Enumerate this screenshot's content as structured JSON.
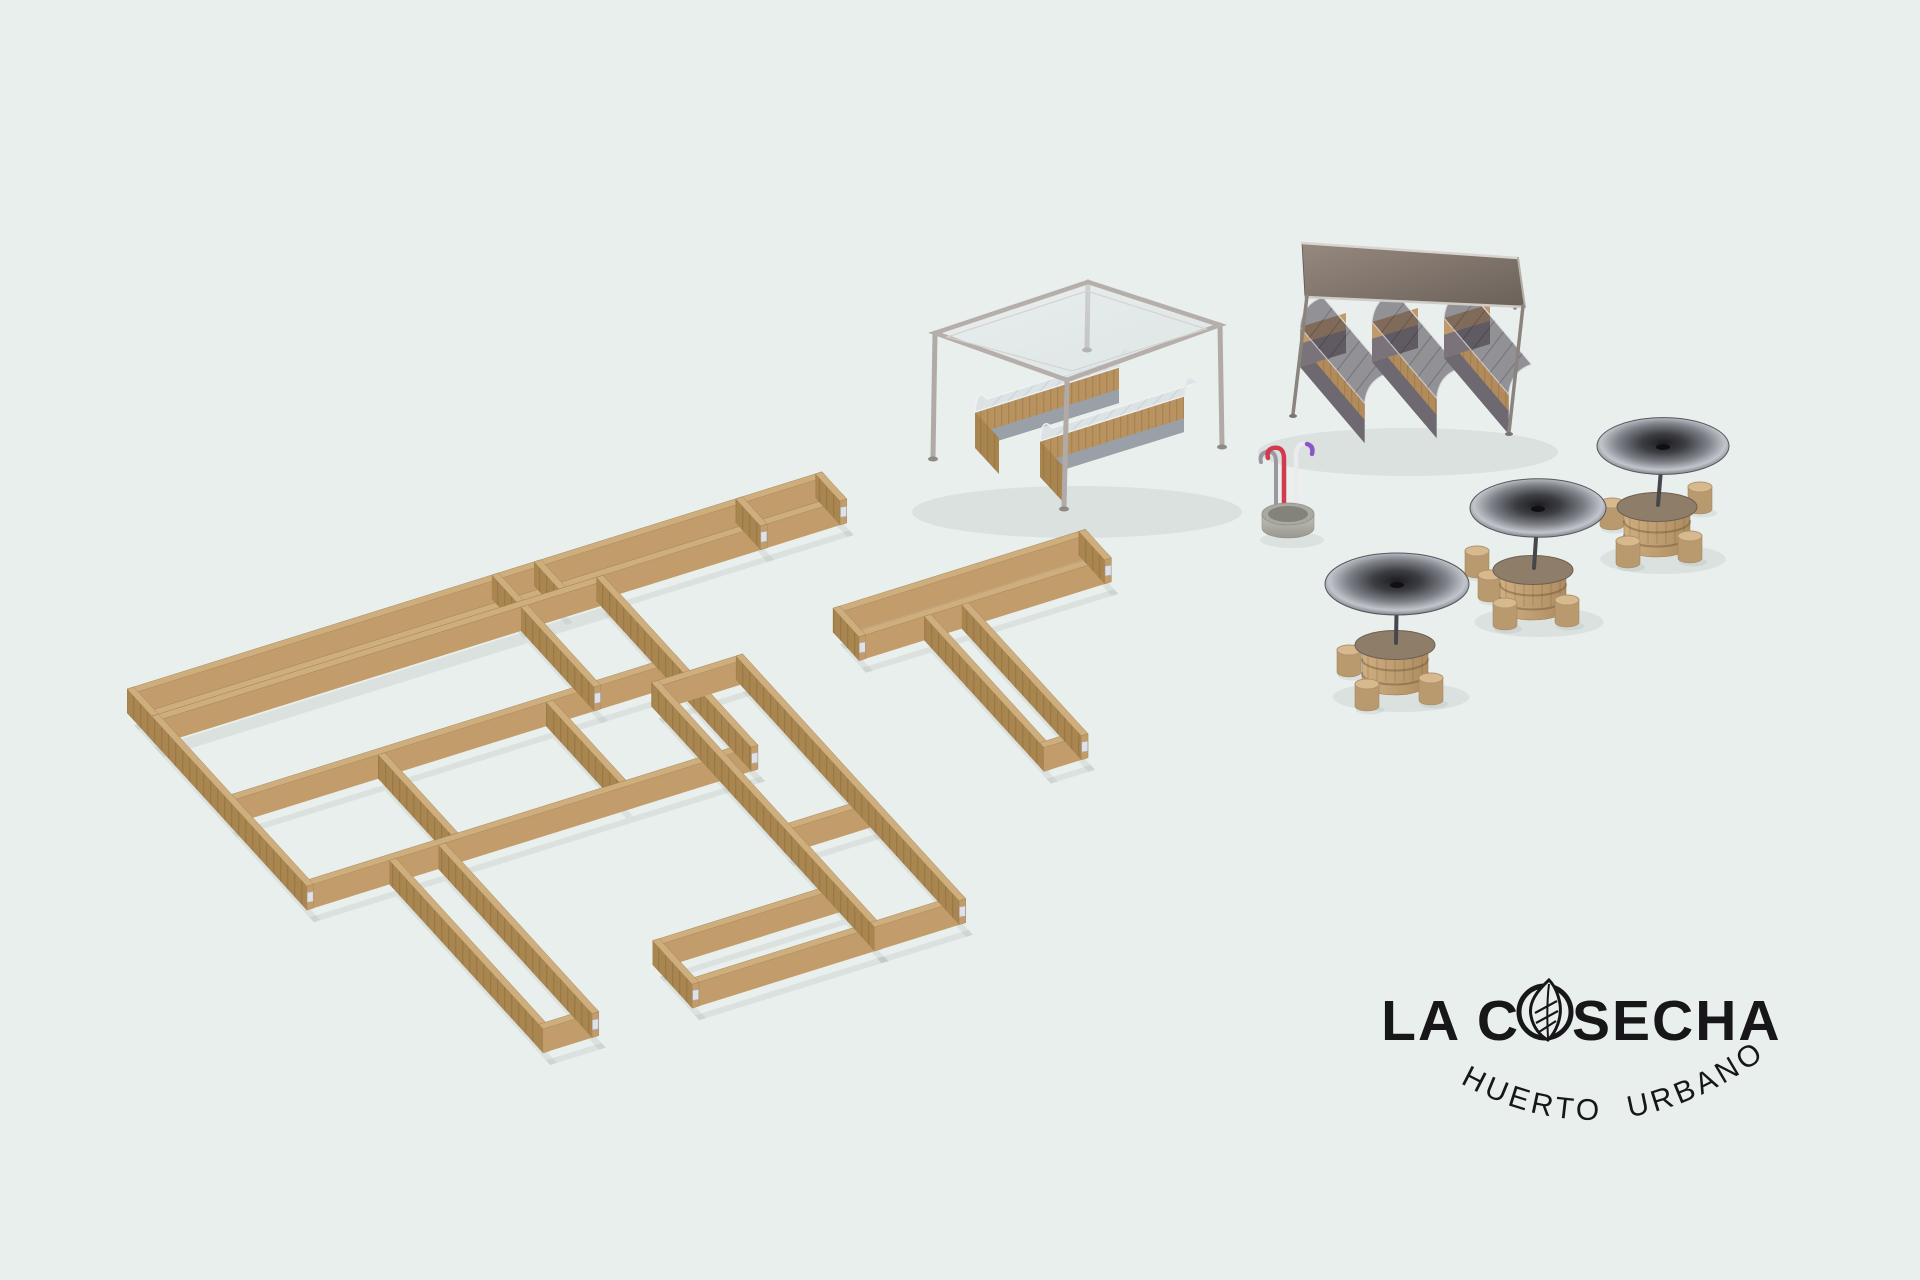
{
  "canvas": {
    "width": 1920,
    "height": 1280,
    "background": "#e9efec"
  },
  "brand": {
    "name": "LA COSECHA",
    "name_pre": "LA C",
    "name_post": "SECHA",
    "subtitle": "HUERTO URBANO",
    "color": "#17171a",
    "leaf_icon": "leaf-in-circle"
  },
  "scene": {
    "iso": {
      "u": [
        0.96,
        -0.3
      ],
      "v": [
        0.62,
        0.68
      ],
      "origin": [
        127,
        713
      ],
      "wall_height": 24,
      "wall_thickness": 7
    },
    "wood": {
      "top": "#cfae7e",
      "face_u": "#c29c6a",
      "face_v": "#a9854f",
      "bracket": "#e0e1e6",
      "bracket_edge": "#a9aab2"
    },
    "shadow_color": "rgba(98,112,104,0.10)",
    "frames": [
      {
        "id": "top-chain",
        "walls": [
          [
            "u",
            0,
            0,
            724
          ],
          [
            "u",
            0,
            33,
            724
          ],
          [
            "v",
            0,
            0,
            40
          ],
          [
            "v",
            717,
            0,
            40
          ],
          [
            "v",
            380,
            0,
            40
          ],
          [
            "v",
            424,
            0,
            40
          ],
          [
            "v",
            634,
            0,
            40
          ]
        ]
      },
      {
        "id": "big-grid",
        "walls": [
          [
            "u",
            0,
            40,
            470
          ],
          [
            "u",
            0,
            158,
            470
          ],
          [
            "u",
            0,
            283,
            470
          ],
          [
            "v",
            0,
            40,
            250
          ],
          [
            "v",
            463,
            40,
            250
          ],
          [
            "v",
            380,
            47,
            118
          ],
          [
            "v",
            155,
            165,
            118
          ],
          [
            "v",
            330,
            165,
            118
          ]
        ]
      },
      {
        "id": "south-wing",
        "walls": [
          [
            "v",
            86,
            290,
            248
          ],
          [
            "v",
            137,
            290,
            248
          ],
          [
            "u",
            86,
            531,
            58
          ]
        ]
      },
      {
        "id": "seven-compound",
        "walls": [
          [
            "u",
            632,
            160,
            263
          ],
          [
            "u",
            632,
            195,
            263
          ],
          [
            "v",
            632,
            160,
            42
          ],
          [
            "v",
            888,
            160,
            42
          ],
          [
            "v",
            700,
            202,
            193
          ],
          [
            "v",
            739,
            202,
            193
          ],
          [
            "u",
            700,
            388,
            46
          ]
        ]
      },
      {
        "id": "tall-compound",
        "walls": [
          [
            "u",
            430,
            180,
            95
          ],
          [
            "v",
            430,
            180,
            360
          ],
          [
            "v",
            518,
            180,
            360
          ],
          [
            "u",
            430,
            390,
            95
          ],
          [
            "u",
            430,
            533,
            95
          ],
          [
            "u",
            240,
            476,
            190
          ],
          [
            "u",
            240,
            533,
            197
          ],
          [
            "v",
            240,
            476,
            64
          ]
        ]
      }
    ],
    "pergola": {
      "frame_color": "#b3acа8",
      "roof": [
        [
          935,
          333
        ],
        [
          1088,
          282
        ],
        [
          1220,
          325
        ],
        [
          1067,
          380
        ]
      ],
      "roof_inset": [
        [
          947,
          337
        ],
        [
          1087,
          291
        ],
        [
          1206,
          329
        ],
        [
          1072,
          371
        ]
      ],
      "legs_back": [
        [
          [
            935,
            333
          ],
          [
            933,
            457
          ]
        ],
        [
          [
            1220,
            325
          ],
          [
            1222,
            445
          ]
        ],
        [
          [
            1088,
            282
          ],
          [
            1087,
            348
          ]
        ]
      ],
      "leg_front": [
        [
          1067,
          380
        ],
        [
          1064,
          507
        ]
      ],
      "planters": [
        {
          "w": [
            975,
            412
          ],
          "len": 150
        },
        {
          "w": [
            1040,
            441
          ],
          "len": 150
        }
      ]
    },
    "canopy": {
      "roof": [
        [
          1302,
          243
        ],
        [
          1518,
          258
        ],
        [
          1525,
          307
        ],
        [
          1305,
          297
        ]
      ],
      "legs": [
        [
          [
            1307,
            296
          ],
          [
            1293,
            414
          ]
        ],
        [
          [
            1523,
            306
          ],
          [
            1509,
            432
          ]
        ],
        [
          [
            1517,
            259
          ],
          [
            1515,
            308
          ]
        ]
      ],
      "planters": [
        {
          "n": [
            1300,
            327
          ],
          "len": 106
        },
        {
          "n": [
            1372,
            322
          ],
          "len": 106
        },
        {
          "n": [
            1444,
            318
          ],
          "len": 106
        }
      ]
    },
    "fountain": {
      "pos": [
        1288,
        514
      ],
      "tube_red": "#d23a50",
      "tube_grey": "#9a97a0",
      "tube_white": "#eceaef",
      "tube_purple": "#8a55c8"
    },
    "tables": [
      {
        "top": [
          1657,
          507
        ],
        "umbrella": [
          1663,
          446
        ],
        "ur": 66,
        "stools": [
          [
            -45,
            -4
          ],
          [
            -29,
            34
          ],
          [
            33,
            29
          ],
          [
            43,
            -20
          ]
        ]
      },
      {
        "top": [
          1533,
          570
        ],
        "umbrella": [
          1538,
          508
        ],
        "ur": 68,
        "stools": [
          [
            -56,
            -19
          ],
          [
            -43,
            5
          ],
          [
            -28,
            33
          ],
          [
            34,
            30
          ]
        ]
      },
      {
        "top": [
          1395,
          645
        ],
        "umbrella": [
          1397,
          584
        ],
        "ur": 72,
        "stools": [
          [
            -46,
            5
          ],
          [
            -28,
            39
          ],
          [
            36,
            33
          ]
        ]
      }
    ]
  }
}
